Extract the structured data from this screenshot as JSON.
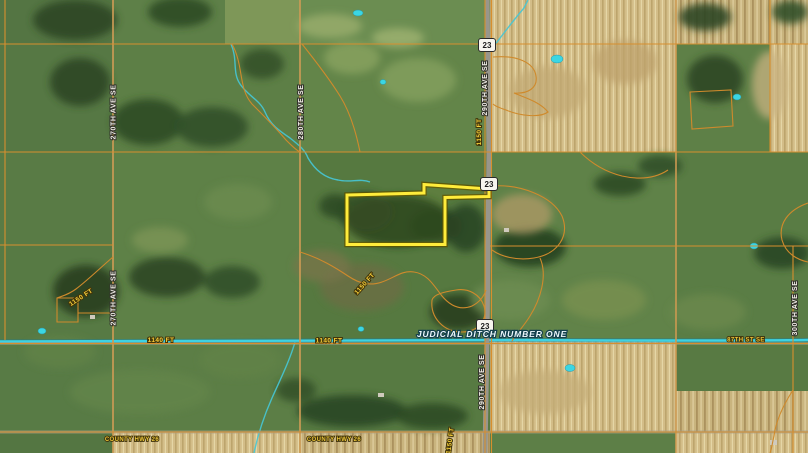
{
  "labels": {
    "highway_number": "23",
    "road_270": "270TH AVE SE",
    "road_280": "280TH AVE SE",
    "road_290": "290TH AVE SE",
    "road_300": "300TH AVE SE",
    "street_87": "87TH ST SE",
    "county_hwy": "COUNTY HWY 26",
    "ditch": "JUDICIAL DITCH NUMBER ONE",
    "dist_1150": "1150 FT",
    "dist_1140": "1140 FT"
  },
  "colors": {
    "boundary_orange": "#d78f2e",
    "parcel_highlight": "#ffec3b",
    "water": "#3ed2e2",
    "label_yellow": "#f7cf3a",
    "label_white": "#f2efe7",
    "shield_white": "#f7f5ef"
  }
}
